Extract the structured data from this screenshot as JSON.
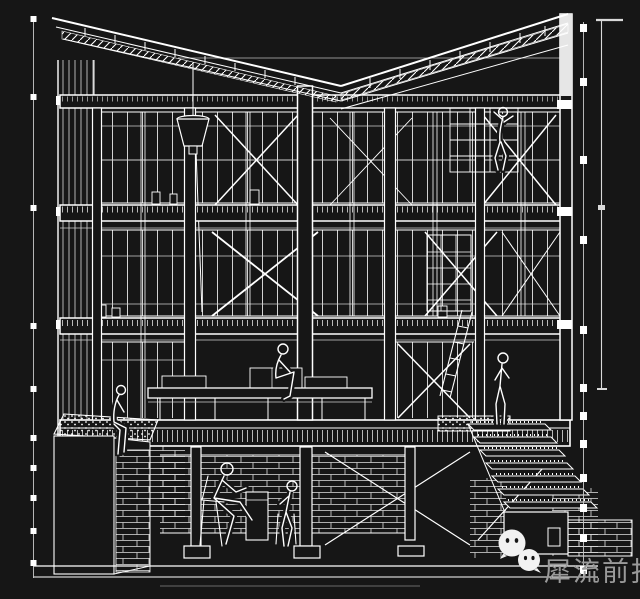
{
  "canvas": {
    "width": 640,
    "height": 599,
    "background_color": "#161616",
    "line_color": "#ffffff",
    "faint_line_color": "#c9c9c9"
  },
  "drawing": {
    "kind": "sectional-perspective-line-drawing",
    "elements": [
      "butterfly-roof-with-rafters",
      "three-floor-slabs",
      "timber-columns",
      "window-mullion-grids",
      "cross-bracing",
      "hanging-rain-funnel",
      "mezzanine-deck",
      "shelf-and-ladder",
      "basement-masonry-wall",
      "stepped-stair",
      "gravel-planter-box",
      "six-human-figures"
    ],
    "annotation_marks": [
      "left-dashed-reference-line",
      "right-dashed-section-line",
      "right-dimension-line-with-ticks",
      "ground-datum-lines"
    ]
  },
  "watermark": {
    "text": "犀流前报",
    "text_color": "#9a9a9a",
    "icon_color": "#f2f2f2",
    "icons": [
      {
        "name": "wechat-icon-large"
      },
      {
        "name": "wechat-icon-small"
      }
    ]
  }
}
